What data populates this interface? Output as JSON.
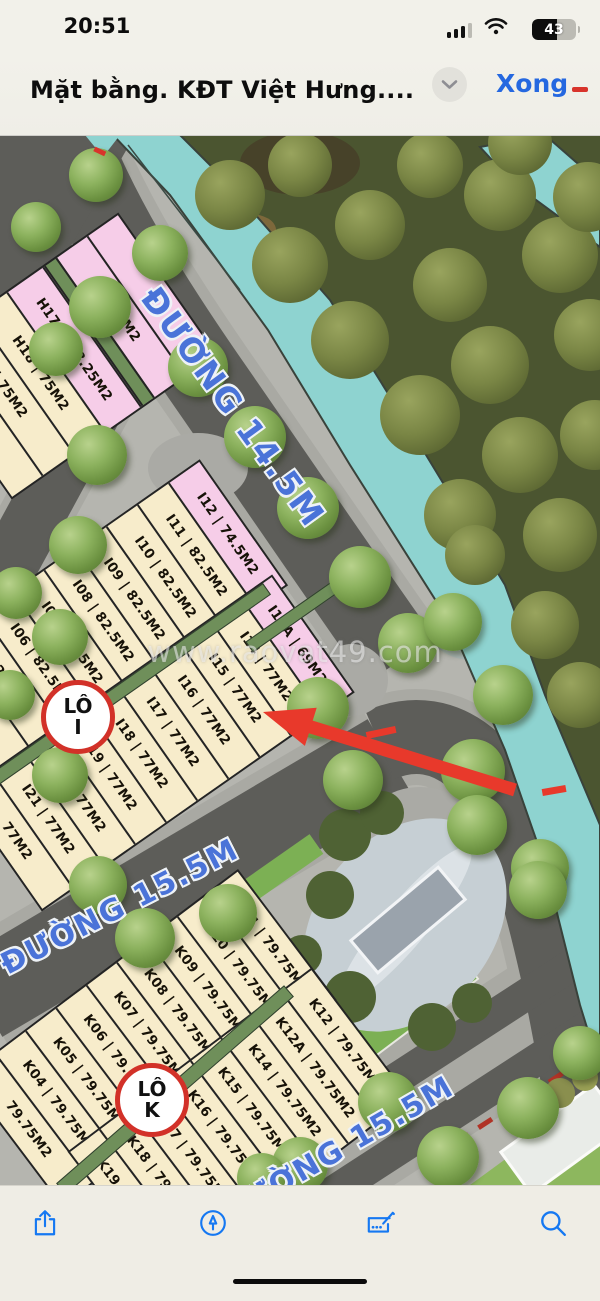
{
  "status_bar": {
    "time": "20:51",
    "battery_percent": "43"
  },
  "nav_bar": {
    "title": "Mặt bằng. KĐT Việt Hưng....",
    "done_label": "Xong"
  },
  "map": {
    "watermark": "www.raovat49.com",
    "roads": {
      "r14": "ĐƯỜNG 14.5M",
      "r15": "ĐƯỜNG 15.5M"
    },
    "badges": {
      "lo_i": {
        "top": "LÔ",
        "bottom": "I"
      },
      "lo_k": {
        "top": "LÔ",
        "bottom": "K"
      }
    },
    "blocks": {
      "h": [
        "",
        "8.25M2",
        "H17 | 108.25M2",
        "H18 | 75M2",
        "| 75M2",
        "75M2"
      ],
      "i_upper": [
        "I12 | 74.5M2",
        "I11 | 82.5M2",
        "I10 | 82.5M2",
        "I09 | 82.5M2",
        "I08 | 82.5M2",
        "I07 | 82.5M2",
        "I06 | 82.5M2",
        "2.5M2",
        "5M2"
      ],
      "i_lower": [
        "I12A | 69M2",
        "I14 | 77M2",
        "I15 | 77M2",
        "I16 | 77M2",
        "I17 | 77M2",
        "I18 | 77M2",
        "I19 | 77M2",
        "I20 | 77M2",
        "I21 | 77M2",
        "77M2"
      ],
      "k_left": [
        "K11 | 79.75M2",
        "K10 | 79.75M2",
        "K09 | 79.75M2",
        "K08 | 79.75M2",
        "K07 | 79.75M2",
        "K06 | 79.75M2",
        "K05 | 79.75M2",
        "K04 | 79.75M2",
        "79.75M2"
      ],
      "k_right": [
        "K12 | 79.75M2",
        "K12A | 79.75M2",
        "K14 | 79.75M2",
        "K15 | 79.75M2",
        "K16 | 79.75M2",
        "K17 | 79.75M2",
        "K18 | 79.75M2",
        "K19 | 79.75M2"
      ]
    },
    "colors": {
      "plot_beige": "#f7eccb",
      "plot_pink": "#f6cde8",
      "canal_teal": "#8ed3d0",
      "road_gray": "#5d5d59",
      "forest_green": "#4b5530",
      "road_label_blue": "#4a73d8",
      "arrow_red": "#e8392b",
      "badge_border_red": "#d23128",
      "accent_blue": "#1578f2"
    }
  },
  "toolbar": {
    "icons": [
      "share",
      "markup",
      "fill-sign",
      "search"
    ]
  }
}
